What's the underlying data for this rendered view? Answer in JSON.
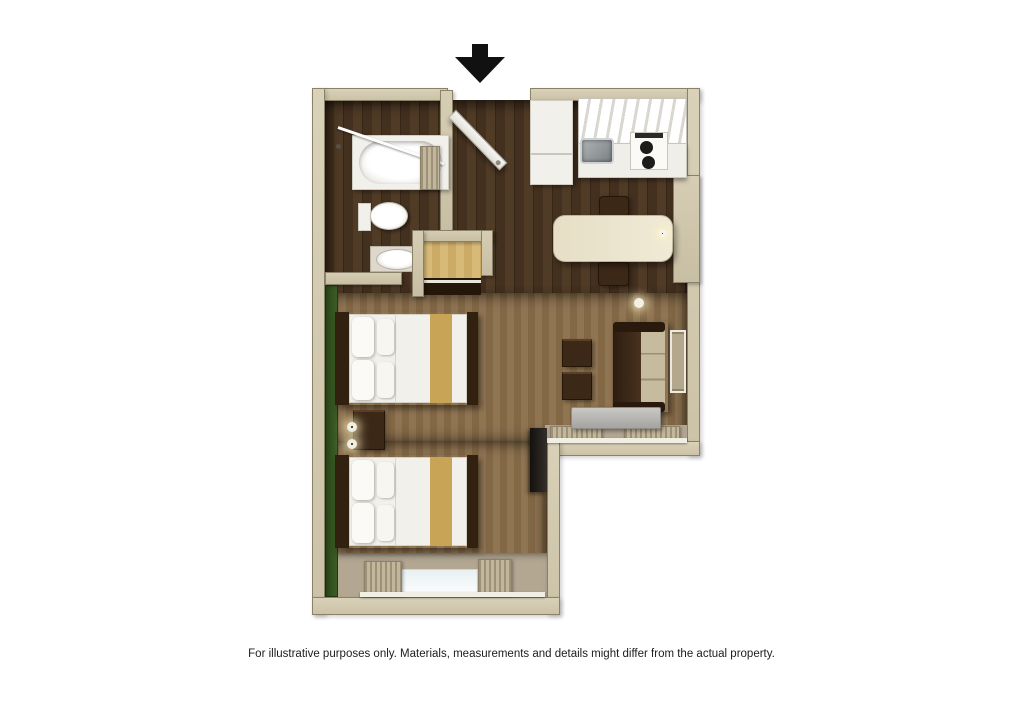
{
  "caption": {
    "text": "For illustrative purposes only.  Materials, measurements and details might differ from the actual property."
  },
  "floor_plan": {
    "title": "3D top-down studio suite floor plan",
    "entrance": {
      "icon": "entrance-arrow-down-icon",
      "shape": "black filled downward arrow marking entry door"
    },
    "colors": {
      "background": "#ffffff",
      "wall_tan": "#cfc6ad",
      "accent_wall_green": "#35521e",
      "wood_floor_dark": "#46331f",
      "carpet_brown": "#8a6e4a",
      "bedding_white": "#f2f0ea",
      "bed_runner_gold": "#c8a457",
      "furniture_dark_wood": "#3a2414",
      "ac_unit_gray": "#b9b8b4"
    },
    "rooms": [
      {
        "name": "bathroom",
        "features": [
          "bathtub",
          "shower-curtain-rod",
          "toilet",
          "sink-vanity"
        ]
      },
      {
        "name": "entry-hall",
        "features": [
          "entry-door-open"
        ]
      },
      {
        "name": "kitchen",
        "features": [
          "refrigerator",
          "upper-cabinets",
          "kitchen-sink",
          "two-burner-stove",
          "dining-table",
          "two-dining-chairs",
          "wall-sconce-light"
        ]
      },
      {
        "name": "closet",
        "features": [
          "shelf",
          "hanging-rod"
        ]
      },
      {
        "name": "sleeping-area",
        "features": [
          "double-bed-1",
          "double-bed-2",
          "nightstand",
          "two-round-wall-lamps",
          "green-accent-wall",
          "window-with-curtains",
          "wall-mounted-tv"
        ]
      },
      {
        "name": "sitting-area",
        "features": [
          "sofa",
          "side-table-1",
          "side-table-2",
          "wall-mirror",
          "ac-unit-under-window",
          "window-with-curtains",
          "round-ceiling-lamp"
        ]
      }
    ]
  }
}
